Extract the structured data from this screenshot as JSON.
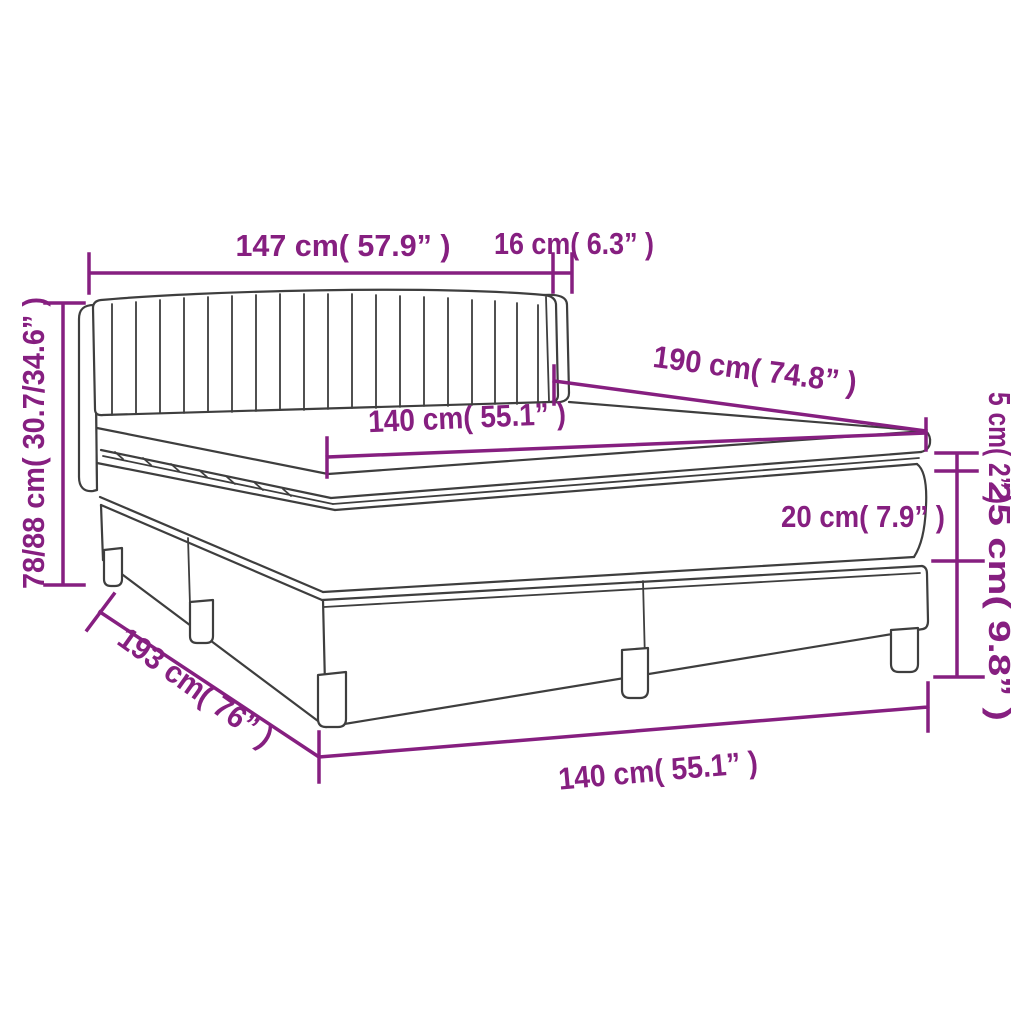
{
  "diagram": {
    "type": "product-dimension-diagram",
    "product": "box-spring-bed-with-headboard-mattress-and-topper",
    "colors": {
      "dimension_accent": "#861f80",
      "outline": "#3e3e3e",
      "background": "#ffffff"
    },
    "labels": {
      "headboard_width": "147 cm( 57.9” )",
      "headboard_side_depth": "16 cm( 6.3” )",
      "height_range": "78/88 cm( 30.7/34.6” )",
      "bed_length": "190 cm( 74.8” )",
      "mattress_width_top": "140 cm( 55.1” )",
      "topper_thickness": "5 cm( 2” )",
      "mattress_thickness": "20 cm( 7.9” )",
      "base_height": "25 cm( 9.8” )",
      "total_depth_diagonal": "193 cm( 76” )",
      "mattress_width_bottom": "140 cm( 55.1” )"
    }
  }
}
